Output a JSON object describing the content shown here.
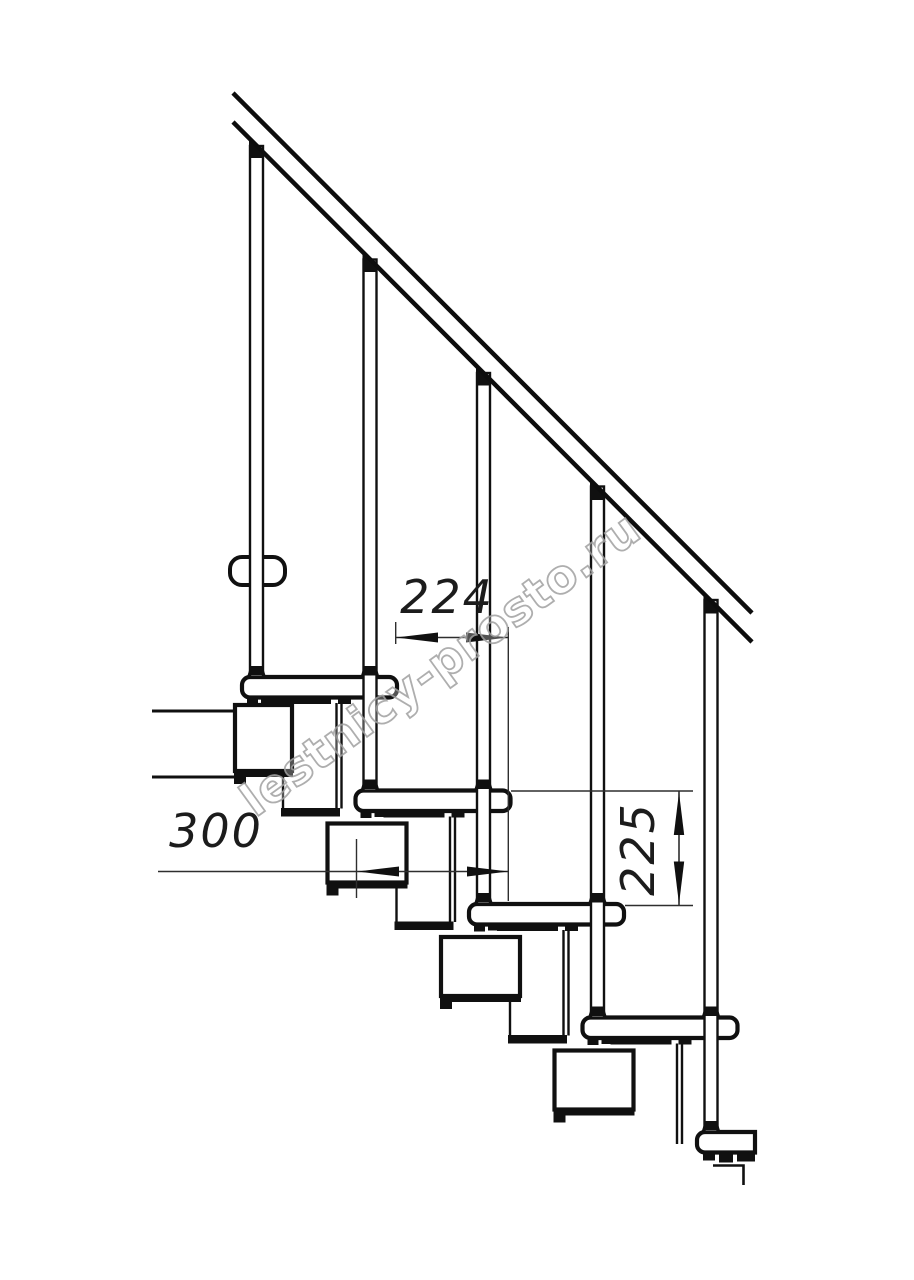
{
  "drawing": {
    "type": "modular-staircase-side-view",
    "dimensions": {
      "step_run": "224",
      "tread_depth": "300",
      "step_rise": "225"
    },
    "watermark": "lestnicy-prosto.ru"
  }
}
